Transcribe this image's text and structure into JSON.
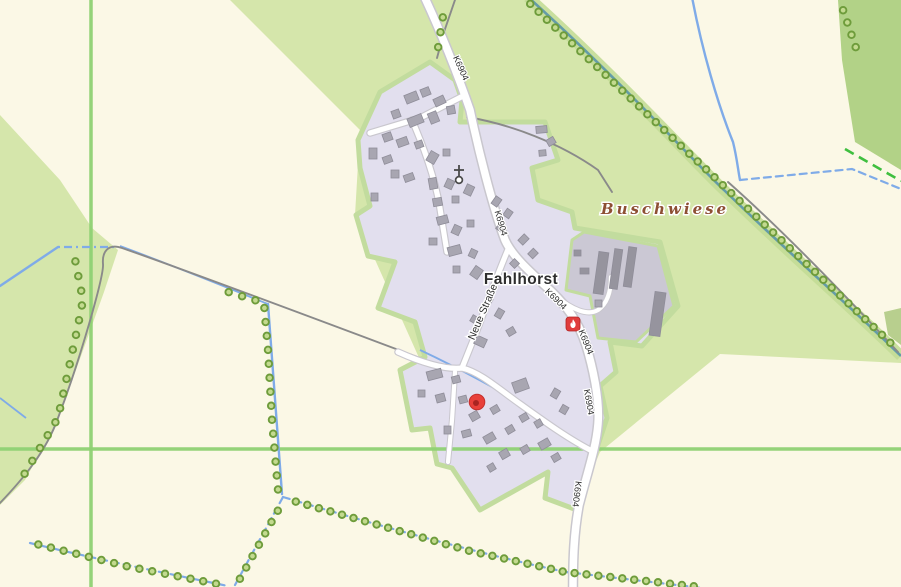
{
  "map": {
    "labels": {
      "place": "Fahlhorst",
      "locality": "Buschwiese",
      "street": "Neue Straße"
    },
    "road_refs": [
      "K6904",
      "K6904",
      "K6904",
      "K6904",
      "K6904",
      "K6904"
    ],
    "markers": [
      {
        "name": "fire-station-icon",
        "type": "fire station",
        "color": "#e03c3c"
      },
      {
        "name": "poi-dot-marker",
        "type": "point of interest",
        "color": "#e8403a"
      },
      {
        "name": "church-icon",
        "type": "church cross",
        "color": "#4a4a4a"
      }
    ]
  },
  "colors": {
    "cream": "#fbf8e6",
    "meadow": "#d5e6ab",
    "meadow_dark": "#b2d287",
    "olive": "#b8cf8e",
    "village": "#e2dfee",
    "village_halo": "#c2dc9e",
    "farmyard": "#cbc8d4",
    "building": "#a8a6b1",
    "building_stroke": "#8f8d99",
    "barn": "#96949e",
    "road": "#ffffff",
    "road_casing": "#c9c7ce",
    "track": "#8a8a8a",
    "stream": "#7fabe8",
    "stream_teal": "#649ca8",
    "band": "#c3dc96",
    "tree_ring": "#6e9c3b",
    "tree_fill": "#c3da8f",
    "grid": "#8ed173",
    "border_dash": "#3fbf3f",
    "label": "#2d2d2d",
    "area_label": "#8d4f33",
    "marker_red": "#e8403a",
    "marker_red_dark": "#9e201d",
    "fire_red": "#e03c3c"
  }
}
